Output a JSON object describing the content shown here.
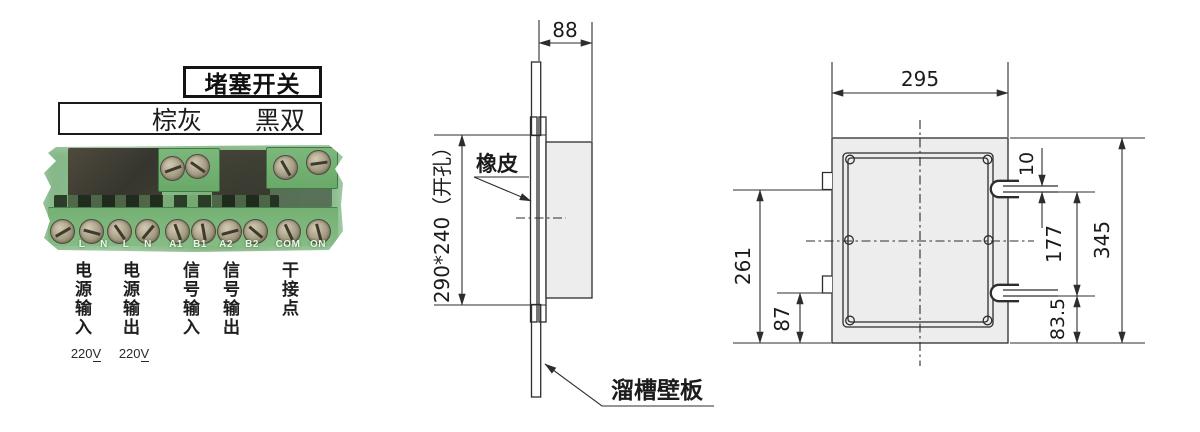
{
  "product": {
    "title": "堵塞开关",
    "wire_labels": {
      "left": "棕灰",
      "right": "黑双"
    }
  },
  "terminal_block": {
    "pin_labels": [
      "L",
      "N",
      "L",
      "N",
      "A1",
      "B1",
      "A2",
      "B2",
      "COM",
      "ON"
    ],
    "groups": [
      {
        "name": "电源输入",
        "voltage": "220",
        "voltage_unit": "V"
      },
      {
        "name": "电源输出",
        "voltage": "220",
        "voltage_unit": "V"
      },
      {
        "name": "信号输入"
      },
      {
        "name": "信号输出"
      },
      {
        "name": "干接点"
      }
    ]
  },
  "side_view": {
    "depth_dim": "88",
    "opening_dim": "290*240（开孔）",
    "rubber_label": "橡皮",
    "wall_label": "溜槽壁板"
  },
  "front_view": {
    "width_dim": "295",
    "height_dim": "345",
    "slot_width_dim": "10",
    "slot_pitch_dim": "177",
    "slot_bottom_dim": "83.5",
    "tab_top_dim": "261",
    "tab_bottom_dim": "87"
  },
  "colors": {
    "pcb_green": "#7fb37f",
    "panel_grey": "#ededed",
    "line": "#2d2d2d"
  }
}
